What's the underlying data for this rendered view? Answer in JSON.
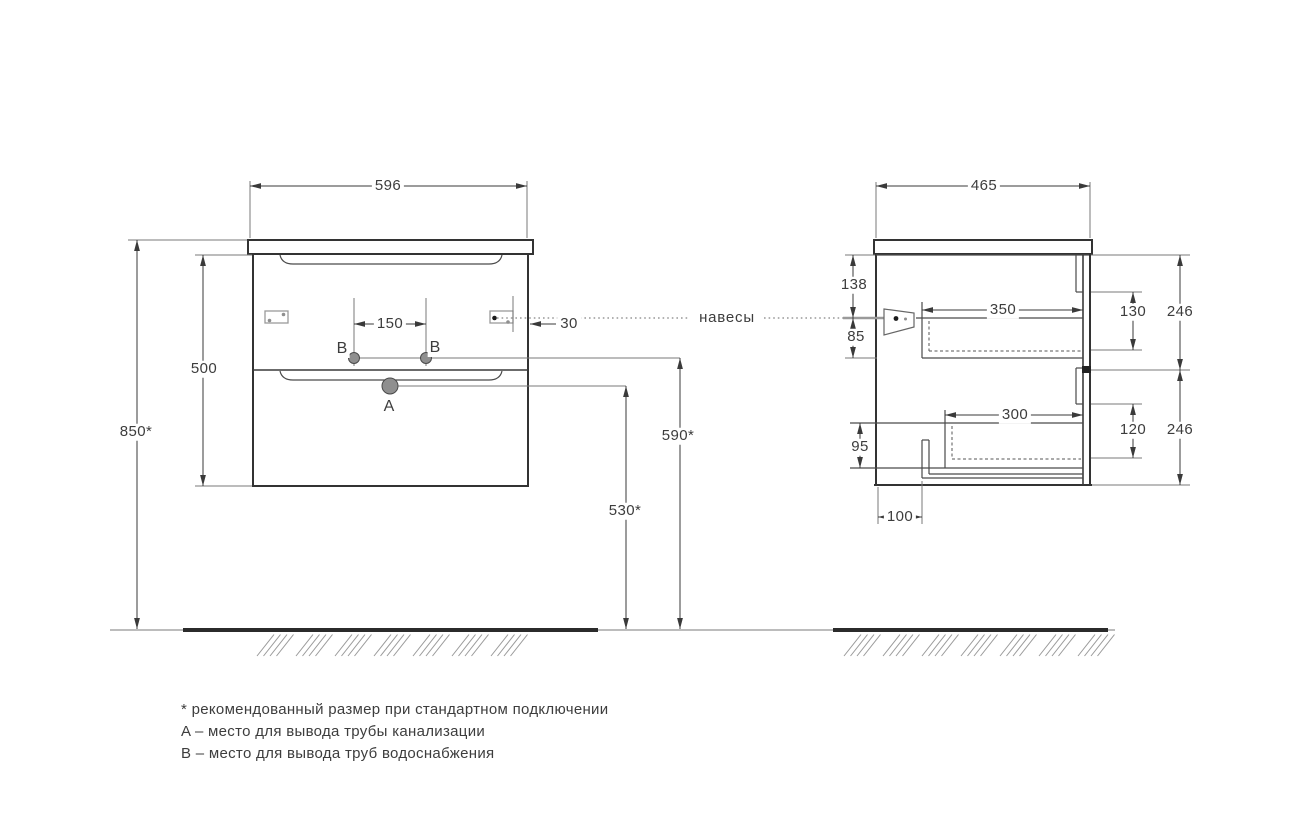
{
  "front_view": {
    "width": "596",
    "carcass_height": "500",
    "mounting_height": "850*",
    "water_outlets_spacing": "150",
    "hanger_side_offset": "30",
    "drain_outlet_height": "530*",
    "water_outlet_height": "590*",
    "drain_marker": "A",
    "water_marker_left": "B",
    "water_marker_right": "B"
  },
  "side_view": {
    "depth": "465",
    "hanger_top_offset": "138",
    "hanger_drop": "85",
    "top_drawer_inner_depth": "350",
    "top_drawer_inner_height": "130",
    "top_front_height": "246",
    "bottom_drawer_inner_depth": "300",
    "bottom_drawer_inner_height": "120",
    "bottom_front_height": "246",
    "bottom_clearance": "95",
    "pipe_cutout_offset": "100"
  },
  "callout": {
    "hangers": "навесы"
  },
  "legend": {
    "asterisk_note": "* рекомендованный размер при стандартном подключении",
    "a_note": "A – место для вывода трубы канализации",
    "b_note": "B – место для вывода труб водоснабжения"
  },
  "colors": {
    "line": "#3a3a3a",
    "hatch": "#9a9a9a",
    "background": "#ffffff"
  }
}
